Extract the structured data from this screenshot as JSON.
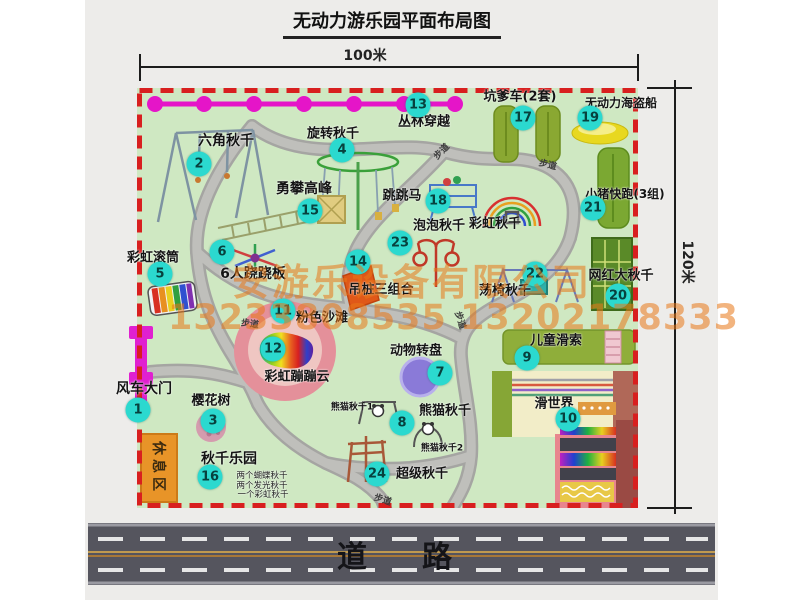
{
  "title": "无动力游乐园平面布局图",
  "dimensions": {
    "width": "100米",
    "height": "120米"
  },
  "road_label": "道路",
  "path_label": "步道",
  "rest_area_label": "休息区",
  "watermark": {
    "line1": "安游乐设备有限公司",
    "line2": "13233808535 13202178333"
  },
  "sublabels": {
    "rainbow_swing": "彩虹秋千",
    "panda1": "熊猫秋千1",
    "panda2": "熊猫秋千2",
    "swing_note1": "两个蝴蝶秋千",
    "swing_note2": "两个发光秋千",
    "swing_note3": "一个彩虹秋千"
  },
  "items": [
    {
      "num": "1",
      "name": "风车大门"
    },
    {
      "num": "2",
      "name": "六角秋千"
    },
    {
      "num": "3",
      "name": "樱花树"
    },
    {
      "num": "4",
      "name": "旋转秋千"
    },
    {
      "num": "5",
      "name": "彩虹滚筒"
    },
    {
      "num": "6",
      "name": "6人跷跷板"
    },
    {
      "num": "7",
      "name": "动物转盘"
    },
    {
      "num": "8",
      "name": "熊猫秋千"
    },
    {
      "num": "9",
      "name": "儿童滑索"
    },
    {
      "num": "10",
      "name": "滑世界"
    },
    {
      "num": "11",
      "name": "粉色沙滩"
    },
    {
      "num": "12",
      "name": "彩虹蹦蹦云"
    },
    {
      "num": "13",
      "name": "丛林穿越"
    },
    {
      "num": "14",
      "name": "吊桩三组合"
    },
    {
      "num": "15",
      "name": "勇攀高峰"
    },
    {
      "num": "16",
      "name": "秋千乐园"
    },
    {
      "num": "17",
      "name": "坑爹车(2套)"
    },
    {
      "num": "18",
      "name": "跳跳马"
    },
    {
      "num": "19",
      "name": "无动力海盗船"
    },
    {
      "num": "20",
      "name": "网红大秋千"
    },
    {
      "num": "21",
      "name": "小猪快跑(3组)"
    },
    {
      "num": "22",
      "name": "荡椅秋千"
    },
    {
      "num": "23",
      "name": "泡泡秋千"
    },
    {
      "num": "24",
      "name": "超级秋千"
    }
  ],
  "colors": {
    "map_green": "#cfe8c2",
    "border_red": "#d81f1f",
    "badge_cyan": "#2bd9cf",
    "zipline_magenta": "#e515c8",
    "gate_magenta": "#e020d0",
    "watermark_orange": "#e87818",
    "road_gray": "#55555e",
    "beach_pink": "#e4909a",
    "rest_orange": "#e89428"
  }
}
